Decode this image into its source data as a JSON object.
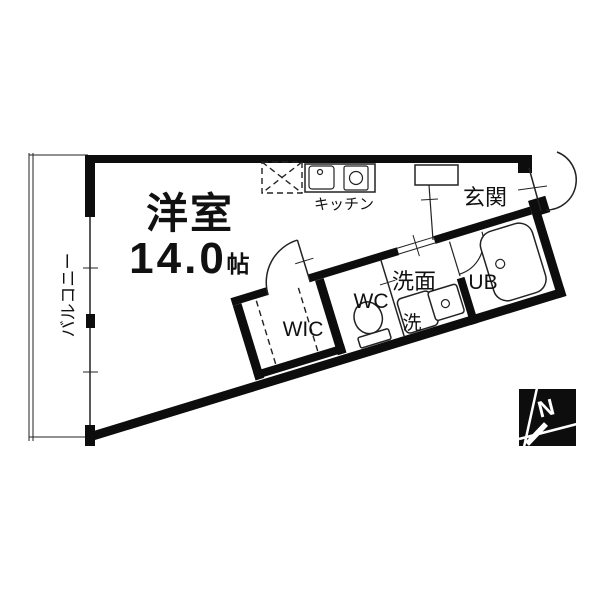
{
  "floorplan": {
    "labels": {
      "main_room": "洋室",
      "main_room_size": "14.0",
      "size_unit": "帖",
      "kitchen": "キッチン",
      "entrance": "玄関",
      "washroom": "洗面",
      "laundry": "洗",
      "toilet": "WC",
      "closet": "WIC",
      "bath": "UB",
      "balcony": "バルコニー"
    },
    "compass": {
      "north": "N"
    },
    "colors": {
      "wall": "#0d0d0d",
      "line": "#222222",
      "background": "#ffffff",
      "compass_background": "#0d0d0d",
      "compass_lines": "#ffffff"
    }
  }
}
